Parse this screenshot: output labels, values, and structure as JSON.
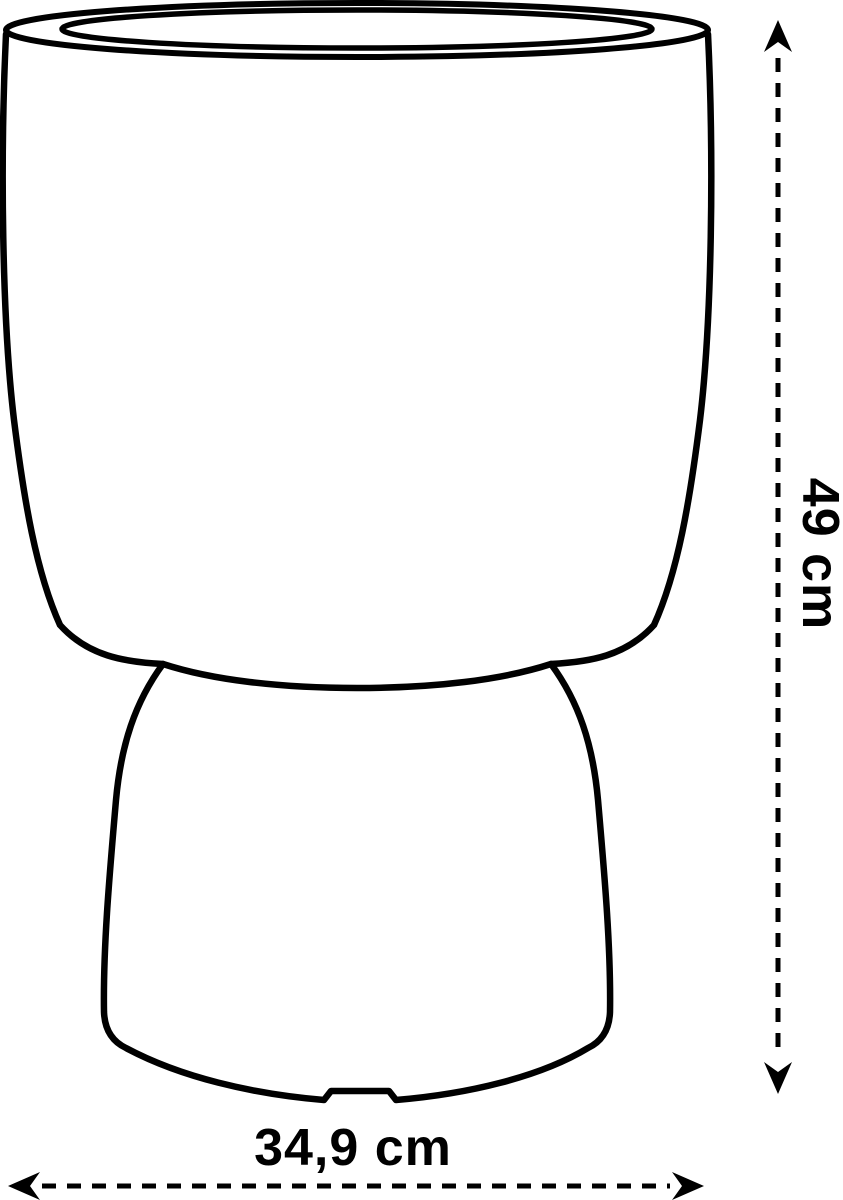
{
  "diagram": {
    "type": "product-dimension-drawing",
    "subject": "flower-pot-coupe-shape",
    "dimensions": {
      "height": {
        "label": "49 cm",
        "orientation": "vertical"
      },
      "width": {
        "label": "34,9 cm",
        "orientation": "horizontal"
      }
    },
    "colors": {
      "line": "#000000",
      "text": "#000000",
      "background": "#ffffff"
    }
  }
}
